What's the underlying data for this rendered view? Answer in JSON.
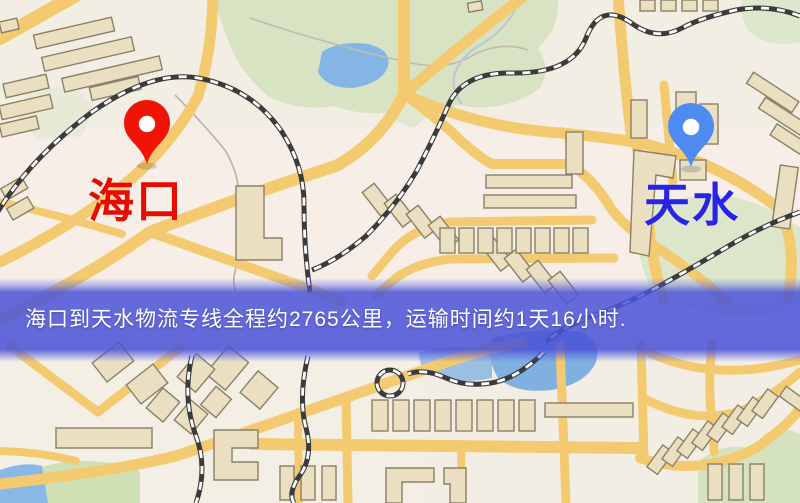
{
  "map": {
    "origin_marker": {
      "name": "海口",
      "pin_color": "#ee1506",
      "label_color": "#e60c00"
    },
    "destination_marker": {
      "name": "天水",
      "pin_color": "#4e8cf2",
      "label_color": "#2823e5"
    },
    "info_banner": {
      "text": "海口到天水物流专线全程约2765公里，运输时间约1天16小时.",
      "background": "#4d55d7",
      "text_color": "#ffffff"
    },
    "route": {
      "distance_km": "2765",
      "duration": "1天16小时"
    },
    "palette": {
      "map_background": "#f3eee4",
      "road": "#f4ca70",
      "park": "#d8e3c3",
      "water": "#84b5e5",
      "railway": "#3b3b3b",
      "building_fill": "#eae0c1",
      "building_stroke": "#8a8066"
    }
  }
}
